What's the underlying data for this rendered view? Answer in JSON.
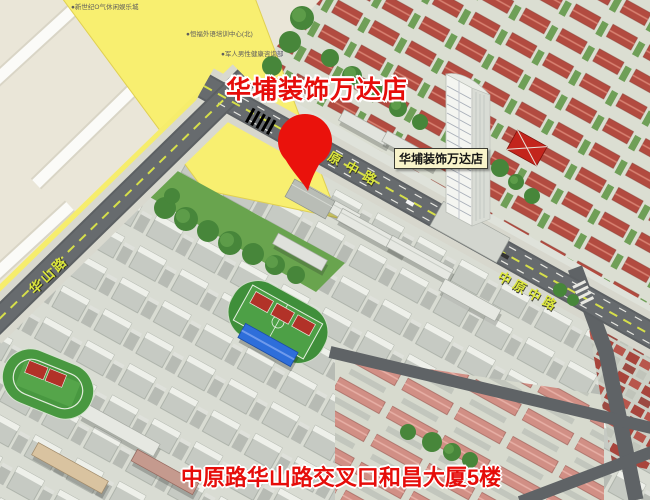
{
  "map": {
    "title_overlay": "华埔装饰万达店",
    "poi_label": "华埔装饰万达店",
    "bottom_caption": "中原路华山路交叉口和昌大厦5楼",
    "road_labels": {
      "huashan": "华山路",
      "zhongyuan_west": "原中路",
      "zhongyuan_east": "中原中路"
    },
    "small_labels": {
      "a": "●新世纪O气休闲娱乐城",
      "b": "●恒福外语培训中心(北)",
      "c": "●军人男性健康咨询部"
    },
    "colors": {
      "accent_red": "#e60d0a",
      "pin_red": "#ea120c",
      "road_label_yellow": "#dce73c",
      "highlight_yellow": "#f8ef70",
      "label_box_bg": "#f9f4ca"
    }
  }
}
